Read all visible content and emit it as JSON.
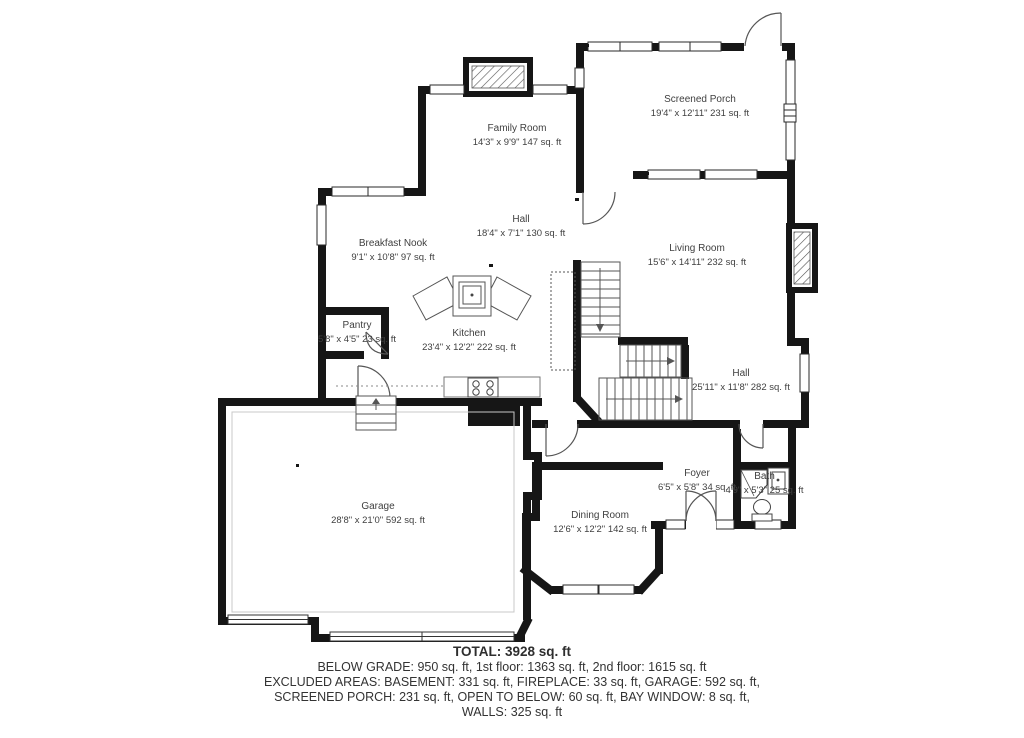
{
  "floorplan": {
    "rooms": [
      {
        "name": "Family Room",
        "dims": "14'3\" x 9'9\" 147 sq. ft"
      },
      {
        "name": "Screened Porch",
        "dims": "19'4\" x 12'11\" 231 sq. ft"
      },
      {
        "name": "Hall",
        "dims": "18'4\" x 7'1\" 130 sq. ft"
      },
      {
        "name": "Breakfast Nook",
        "dims": "9'1\" x 10'8\" 97 sq. ft"
      },
      {
        "name": "Living Room",
        "dims": "15'6\" x 14'11\" 232 sq. ft"
      },
      {
        "name": "Pantry",
        "dims": "5'8\" x 4'5\" 23 sq. ft"
      },
      {
        "name": "Kitchen",
        "dims": "23'4\" x 12'2\" 222 sq. ft"
      },
      {
        "name": "Hall",
        "dims": "25'11\" x 11'8\" 282 sq. ft"
      },
      {
        "name": "Garage",
        "dims": "28'8\" x 21'0\" 592 sq. ft"
      },
      {
        "name": "Dining Room",
        "dims": "12'6\" x 12'2\" 142 sq. ft"
      },
      {
        "name": "Foyer",
        "dims": "6'5\" x 5'8\" 34 sq. ft"
      },
      {
        "name": "Bath",
        "dims": "4'9\" x 5'3\" 25 sq. ft"
      }
    ],
    "summary": {
      "total": "TOTAL: 3928 sq. ft",
      "line1": "BELOW GRADE: 950 sq. ft, 1st floor: 1363 sq. ft, 2nd floor: 1615 sq. ft",
      "line2": "EXCLUDED AREAS: BASEMENT: 331 sq. ft, FIREPLACE: 33 sq. ft, GARAGE: 592 sq. ft,",
      "line3": "SCREENED PORCH: 231 sq. ft, OPEN TO BELOW: 60 sq. ft, BAY WINDOW: 8 sq. ft,",
      "line4": "WALLS: 325 sq. ft"
    },
    "colors": {
      "wall": "#161616",
      "text": "#3f3f3f"
    }
  }
}
